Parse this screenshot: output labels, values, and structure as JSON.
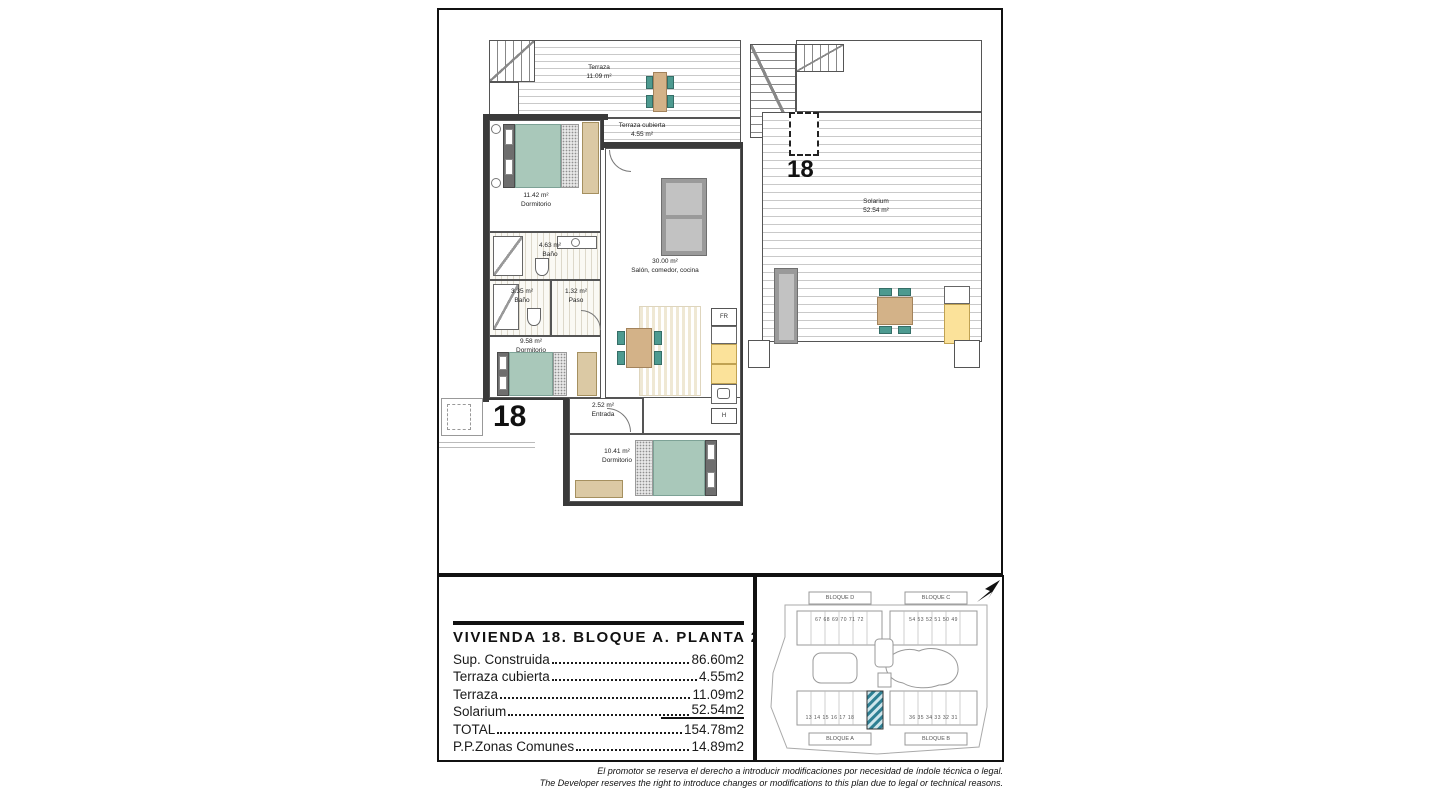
{
  "colors": {
    "wall_dark": "#3a3a3a",
    "furniture_teal": "#4d9a90",
    "bed_teal": "#a9c8ba",
    "wood_beige": "#d3b288",
    "wardrobe_beige": "#dbc9a4",
    "kitchen_yellow": "#fbe29a",
    "sofa_grey": "#9a9a9a",
    "site_highlight_teal": "#2e7f93"
  },
  "main_plan": {
    "unit_number": "18",
    "labels": {
      "terraza": {
        "l1": "Terraza",
        "l2": "11.09 m²"
      },
      "terraza_cubierta": {
        "l1": "Terraza cubierta",
        "l2": "4.55 m²"
      },
      "dormitorio1": {
        "l1": "11.42 m²",
        "l2": "Dormitorio"
      },
      "bano1": {
        "l1": "4.63 m²",
        "l2": "Baño"
      },
      "bano2": {
        "l1": "3.35 m²",
        "l2": "Baño"
      },
      "paso": {
        "l1": "1.32 m²",
        "l2": "Paso"
      },
      "dormitorio2": {
        "l1": "9.58 m²",
        "l2": "Dormitorio"
      },
      "salon": {
        "l1": "30.00 m²",
        "l2": "Salón, comedor, cocina"
      },
      "entrada": {
        "l1": "2.52 m²",
        "l2": "Entrada"
      },
      "dormitorio3": {
        "l1": "10.41 m²",
        "l2": "Dormitorio"
      }
    },
    "appliances": {
      "fridge": "FR",
      "hob": "H"
    }
  },
  "solarium_plan": {
    "unit_number": "18",
    "label": {
      "l1": "Solarium",
      "l2": "52.54 m²"
    }
  },
  "site_plan": {
    "blocks": {
      "d": "BLOQUE D",
      "c": "BLOQUE C",
      "a": "BLOQUE A",
      "b": "BLOQUE B"
    },
    "units": {
      "top_left": "67 68 69 70 71 72",
      "top_right": "54 53 52 51 50 49",
      "bottom_left": "13 14 15 16 17 18",
      "bottom_right": "36 35 34 33 32 31"
    }
  },
  "summary": {
    "title": "VIVIENDA 18. BLOQUE A. PLANTA 2ª",
    "rows": [
      {
        "label": "Sup. Construida",
        "value": "86.60m2"
      },
      {
        "label": "Terraza cubierta",
        "value": "4.55m2"
      },
      {
        "label": "Terraza",
        "value": "11.09m2"
      },
      {
        "label": "Solarium",
        "value": "52.54m2"
      },
      {
        "label": "TOTAL",
        "value": "154.78m2"
      },
      {
        "label": "P.P.Zonas Comunes",
        "value": "14.89m2"
      }
    ]
  },
  "disclaimer": {
    "es": "El promotor se reserva el derecho a introducir modificaciones por necesidad de índole técnica o legal.",
    "en": "The Developer reserves the right to introduce changes or modifications to this plan due to legal or technical reasons."
  }
}
